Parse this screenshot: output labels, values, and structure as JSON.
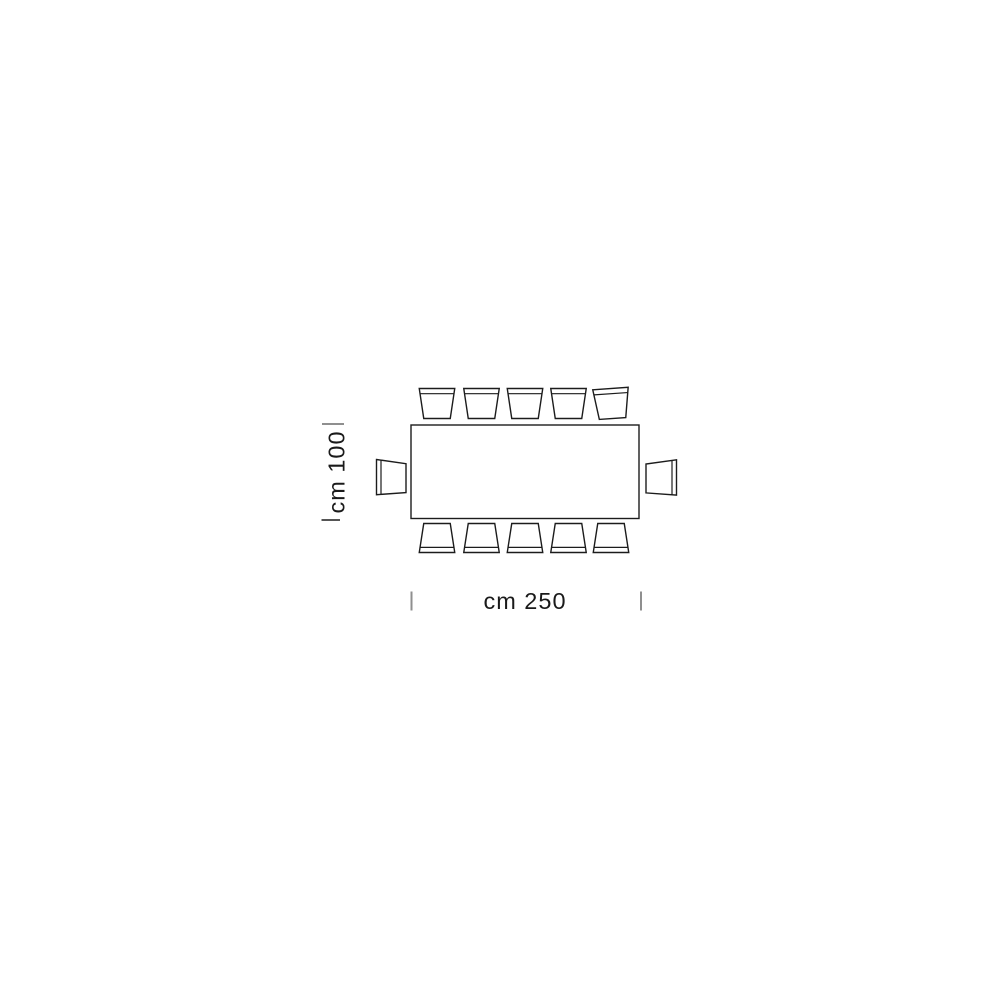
{
  "page": {
    "background_color": "#ffffff",
    "description": "Top-view dimension drawing of a rectangular dining table with 12 chairs"
  },
  "diagram": {
    "type": "furniture-top-view-dimension-drawing",
    "table_shape": "rectangle",
    "width_dimension": {
      "label": "cm 250",
      "value_cm": 250,
      "orientation": "horizontal"
    },
    "depth_dimension": {
      "label": "cm 100",
      "value_cm": 100,
      "orientation": "vertical"
    },
    "chairs": {
      "total": 12,
      "top_row": 5,
      "bottom_row": 5,
      "left_end": 1,
      "right_end": 1
    },
    "line_color": "#1c1c1c",
    "tick_color": "#8f8f8f",
    "text_color": "#1a1a1a"
  }
}
